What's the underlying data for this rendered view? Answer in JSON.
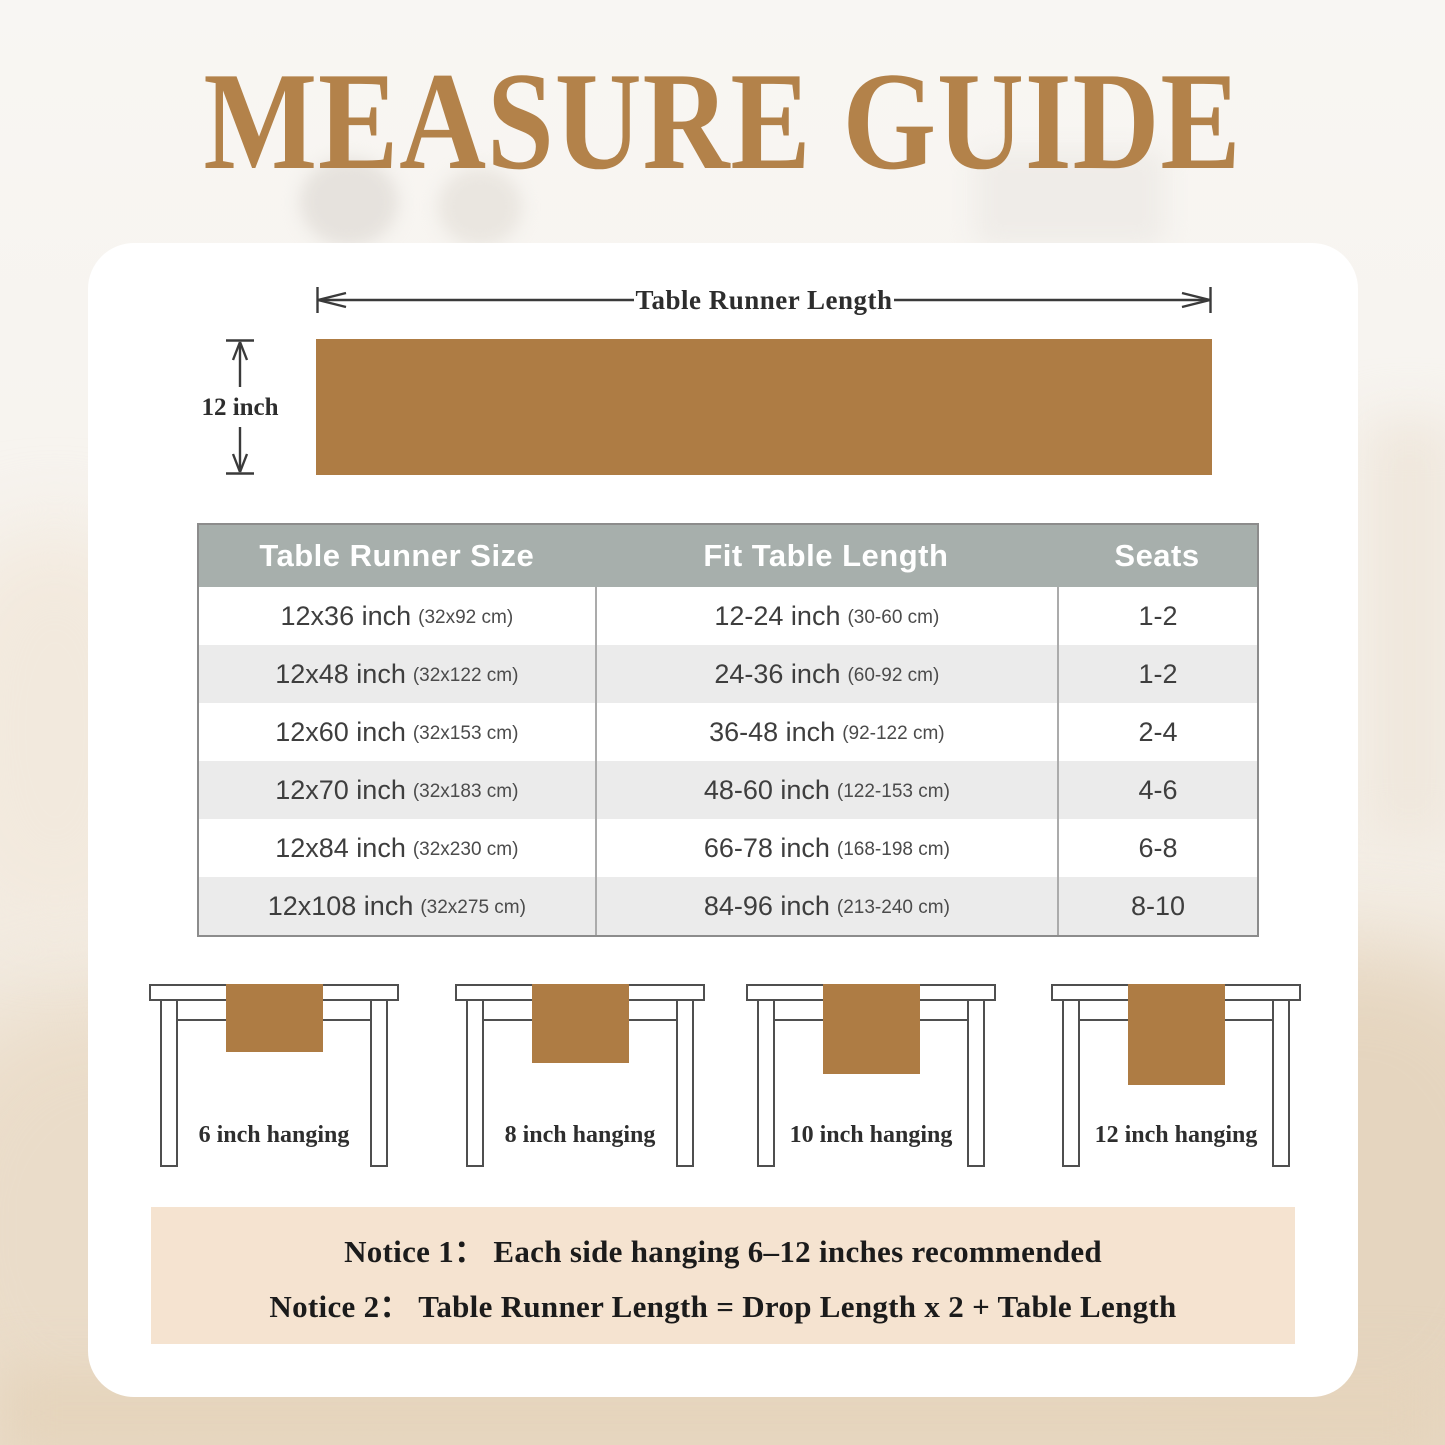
{
  "title": "MEASURE GUIDE",
  "diagram": {
    "length_label": "Table Runner Length",
    "height_label": "12 inch"
  },
  "size_table": {
    "headers": [
      "Table Runner Size",
      "Fit Table Length",
      "Seats"
    ],
    "rows": [
      {
        "size": "12x36 inch",
        "size_cm": "(32x92 cm)",
        "fit": "12-24 inch",
        "fit_cm": "(30-60 cm)",
        "seats": "1-2"
      },
      {
        "size": "12x48 inch",
        "size_cm": "(32x122 cm)",
        "fit": "24-36 inch",
        "fit_cm": "(60-92 cm)",
        "seats": "1-2"
      },
      {
        "size": "12x60 inch",
        "size_cm": "(32x153 cm)",
        "fit": "36-48 inch",
        "fit_cm": "(92-122 cm)",
        "seats": "2-4"
      },
      {
        "size": "12x70 inch",
        "size_cm": "(32x183 cm)",
        "fit": "48-60 inch",
        "fit_cm": "(122-153 cm)",
        "seats": "4-6"
      },
      {
        "size": "12x84 inch",
        "size_cm": "(32x230 cm)",
        "fit": "66-78 inch",
        "fit_cm": "(168-198 cm)",
        "seats": "6-8"
      },
      {
        "size": "12x108 inch",
        "size_cm": "(32x275 cm)",
        "fit": "84-96 inch",
        "fit_cm": "(213-240 cm)",
        "seats": "8-10"
      }
    ]
  },
  "hanging_examples": [
    {
      "label": "6 inch hanging"
    },
    {
      "label": "8 inch hanging"
    },
    {
      "label": "10 inch hanging"
    },
    {
      "label": "12 inch hanging"
    }
  ],
  "notices": {
    "line1": "Notice 1： Each side hanging 6–12 inches recommended",
    "line2": "Notice 2： Table Runner Length = Drop Length x 2 + Table Length"
  },
  "colors": {
    "accent_gold": "#b3824a",
    "runner_brown": "#ae7c44",
    "table_header_gray": "#a7afac",
    "row_alt_gray": "#ebebeb",
    "notice_bg": "#f5e3d0"
  }
}
